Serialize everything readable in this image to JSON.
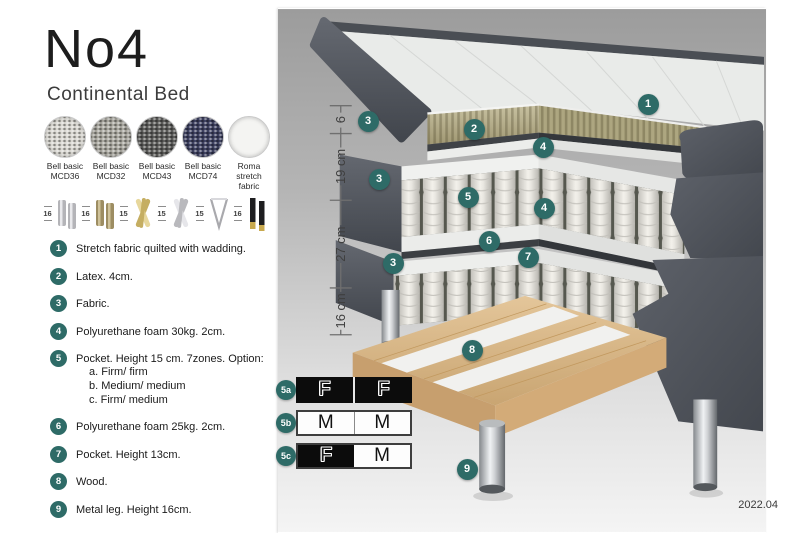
{
  "header": {
    "title": "No4",
    "subtitle": "Continental Bed"
  },
  "colors": {
    "badge_teal": "#2e6b67",
    "firm_black": "#0c0c0c",
    "panel_gray_top": "#9c9c9c",
    "panel_gray_bottom": "#f4f4f4"
  },
  "swatches": [
    {
      "line1": "Bell basic",
      "line2": "MCD36",
      "color": "#d9d7d1",
      "textured": true
    },
    {
      "line1": "Bell basic",
      "line2": "MCD32",
      "color": "#a8a69e",
      "textured": true
    },
    {
      "line1": "Bell basic",
      "line2": "MCD43",
      "color": "#5c5c5a",
      "textured": true
    },
    {
      "line1": "Bell basic",
      "line2": "MCD74",
      "color": "#3e4161",
      "textured": true
    },
    {
      "line1": "Roma",
      "line2": "stretch fabric",
      "color": "#f4f4f2",
      "textured": false
    }
  ],
  "legs": [
    {
      "height": "16",
      "type": "cylinder-pair",
      "color": "#b4b4b8",
      "accent": "#e9e9ec"
    },
    {
      "height": "16",
      "type": "cylinder-pair",
      "color": "#9d8d62",
      "accent": "#cfc29a"
    },
    {
      "height": "15",
      "type": "cross",
      "color": "#c5ae62",
      "accent": "#e7d79c"
    },
    {
      "height": "15",
      "type": "cross",
      "color": "#b9b9bd",
      "accent": "#e6e6ea"
    },
    {
      "height": "15",
      "type": "hairpin",
      "color": "#a9a9ad",
      "accent": "#d8d8dc"
    },
    {
      "height": "16",
      "type": "tapered-pair",
      "color": "#1e1e20",
      "accent": "#c8a94e"
    }
  ],
  "features": [
    {
      "num": "1",
      "text": "Stretch fabric quilted with wadding."
    },
    {
      "num": "2",
      "text": "Latex. 4cm."
    },
    {
      "num": "3",
      "text": "Fabric."
    },
    {
      "num": "4",
      "text": "Polyurethane foam 30kg. 2cm."
    },
    {
      "num": "5",
      "text": "Pocket. Height 15 cm. 7zones. Option:",
      "options": [
        "a. Firm/ firm",
        "b. Medium/ medium",
        "c. Firm/ medium"
      ]
    },
    {
      "num": "6",
      "text": "Polyurethane foam 25kg. 2cm."
    },
    {
      "num": "7",
      "text": "Pocket. Height 13cm."
    },
    {
      "num": "8",
      "text": "Wood."
    },
    {
      "num": "9",
      "text": "Metal leg. Height 16cm."
    }
  ],
  "diagram": {
    "ruler": {
      "labels": [
        "6",
        "19 cm",
        "27 cm",
        "16 cm"
      ]
    },
    "badges": [
      {
        "n": "1",
        "x": 370,
        "y": 96
      },
      {
        "n": "2",
        "x": 196,
        "y": 121
      },
      {
        "n": "3",
        "x": 90,
        "y": 113
      },
      {
        "n": "3",
        "x": 101,
        "y": 171
      },
      {
        "n": "3",
        "x": 115,
        "y": 255
      },
      {
        "n": "4",
        "x": 265,
        "y": 139
      },
      {
        "n": "4",
        "x": 266,
        "y": 200
      },
      {
        "n": "5",
        "x": 190,
        "y": 189
      },
      {
        "n": "6",
        "x": 211,
        "y": 233
      },
      {
        "n": "7",
        "x": 250,
        "y": 249
      },
      {
        "n": "8",
        "x": 194,
        "y": 342
      },
      {
        "n": "9",
        "x": 189,
        "y": 461
      }
    ],
    "firmness": [
      {
        "label": "5a",
        "y": 368,
        "cells": [
          {
            "letter": "F",
            "bg": "black"
          },
          {
            "letter": "F",
            "bg": "black"
          }
        ]
      },
      {
        "label": "5b",
        "y": 401,
        "cells": [
          {
            "letter": "M",
            "bg": "white"
          },
          {
            "letter": "M",
            "bg": "white"
          }
        ]
      },
      {
        "label": "5c",
        "y": 434,
        "cells": [
          {
            "letter": "F",
            "bg": "black"
          },
          {
            "letter": "M",
            "bg": "white"
          }
        ]
      }
    ],
    "date": "2022.04"
  }
}
